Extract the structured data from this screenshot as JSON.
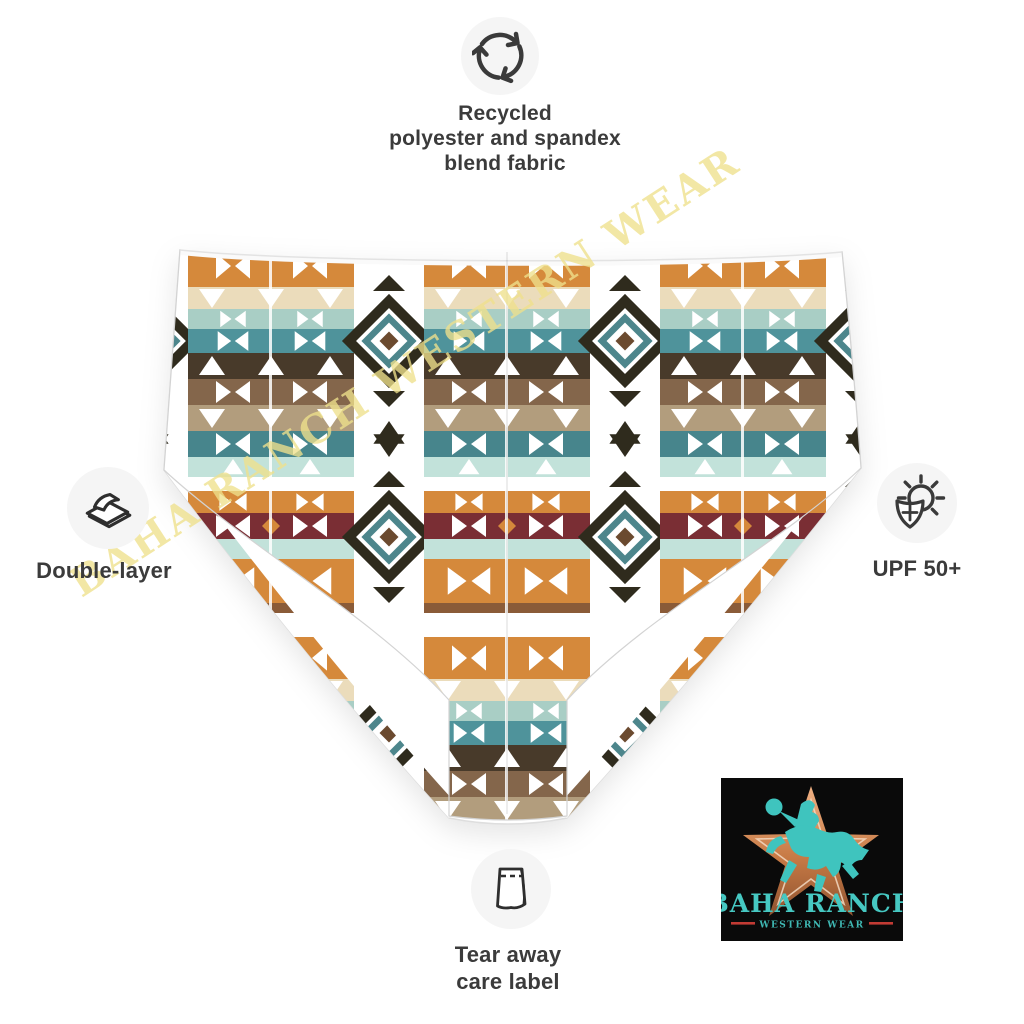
{
  "subject": "high-waisted bikini bottom, aztec tribal print, flat product photo",
  "callouts": {
    "top": {
      "icon": "recycle-icon",
      "label": "Recycled\npolyester and spandex\nblend fabric"
    },
    "left": {
      "icon": "layers-icon",
      "label": "Double-layer"
    },
    "right": {
      "icon": "sun-shield-icon",
      "label": "UPF 50+"
    },
    "bottom": {
      "icon": "care-label-icon",
      "label": "Tear away\ncare label"
    }
  },
  "watermark": {
    "text": "BAHA RANCH WESTERN WEAR",
    "color": "#efe18c"
  },
  "logo": {
    "title": "BAHA RANCH",
    "subtitle": "WESTERN WEAR",
    "background": "#0a0a0a",
    "star_color": "#c77a45",
    "rider_color": "#3fc4be",
    "title_color": "#46c8c2",
    "accent_line_color": "#c23b34"
  },
  "style": {
    "icon_stroke": "#3a3a3a",
    "icon_circle_bg": "#f5f5f5",
    "label_color": "#3b3b3b",
    "pattern_colors": [
      "#d5893b",
      "#ebdcbb",
      "#a9cec5",
      "#4f939b",
      "#483a2a",
      "#84664b",
      "#b29d7d",
      "#47858c",
      "#c2e2da",
      "#7a2e34",
      "#2f2b1d",
      "#8a5b38",
      "#ffffff"
    ]
  }
}
